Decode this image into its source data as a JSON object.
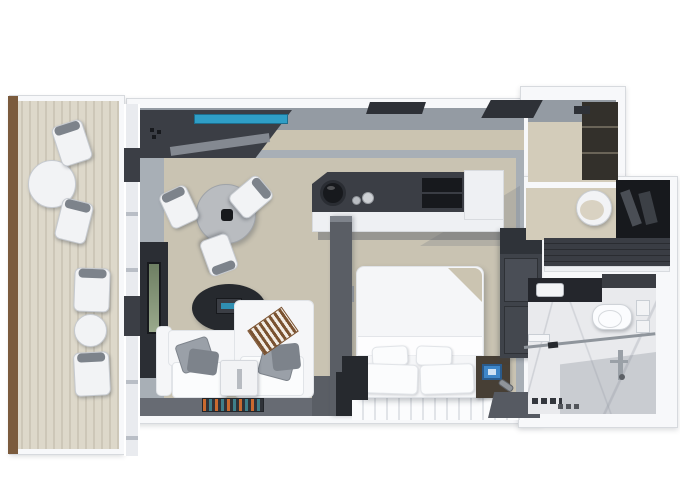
{
  "canvas": {
    "width": 680,
    "height": 486,
    "background": "#ffffff",
    "content_type": "3d-rendered suite floor plan, no text"
  },
  "palette": {
    "bg": "#ffffff",
    "wallWhite": "#f7f8fa",
    "wallEdge": "#d7dade",
    "wallGray": "#949ba3",
    "wallBeige": "#cbc4b1",
    "beigeFloor": "#d3ccba",
    "floorGray": "#a8afb6",
    "carpet": "#c9c3b2",
    "deckA": "#ddd8ca",
    "deckB": "#cdc7b8",
    "wood": "#7b5b3d",
    "dark": "#3b3e45",
    "darker": "#26292e",
    "darkest": "#17191d",
    "slate": "#5a5e65",
    "slate2": "#676b73",
    "sofaWhite": "#f5f6f8",
    "cushion": "#fbfcfd",
    "cushionEdge": "#e1e4e8",
    "pillow": "#9aa0a8",
    "pillowDark": "#7d838b",
    "throwBrown": "#7a5230",
    "throwCream": "#f2ece4",
    "teal": "#2f9ec6",
    "tealDark": "#1d6e8e",
    "safeBlue": "#3e86c8",
    "marble": "#e9eaed",
    "showerShade": "rgba(130,136,145,0.30)",
    "woodNight": "#473f35",
    "tvGreen1": "#6e7f63",
    "tvGreen2": "#9aa98c",
    "chairWhite": "#f2f3f5",
    "chairEdge": "#c6cad0",
    "tableGray": "#b9bcc0",
    "closetBrown": "#33302b",
    "rugBase": "#2f3238",
    "rugOrange": "#c96a2f",
    "rugTeal": "#3f7f8a",
    "threshold": "#565a62",
    "wardrobe": "#3f434a",
    "wardrobeDoor": "#4a4e56",
    "counter": "#3a3d44",
    "basinBeige": "#d9d2c2"
  },
  "rooms": [
    {
      "id": "balcony",
      "label": "Balcony",
      "furniture": [
        "round dining table",
        "2 dining chairs",
        "2 lounge chairs",
        "round side table",
        "wood deck planks",
        "wood privacy divider"
      ]
    },
    {
      "id": "living-room",
      "label": "Living Room",
      "furniture": [
        "media console with teal screen strip",
        "wall tv unit",
        "round dining table with 3 white chairs",
        "dark oval side table with radio-clock",
        "white sofa with 2 gray pillows and striped brown throw",
        "white coffee table",
        "multicolor doormat rug"
      ]
    },
    {
      "id": "bedroom",
      "label": "Bedroom",
      "furniture": [
        "double bed with folded beige corner and 4 white pillows",
        "dark left nightstand",
        "wood right nightstand with blue-screen tablet",
        "flashlight",
        "minibar console with ice bucket, bottles and cabinet",
        "partition wall",
        "white plank floor strip",
        "wardrobe column"
      ]
    },
    {
      "id": "entry-hall",
      "label": "Entry Hall",
      "furniture": [
        "dark entry closet",
        "ceiling vents on top wall"
      ]
    },
    {
      "id": "dressing-area",
      "label": "Dressing Area",
      "furniture": [
        "round vanity basin",
        "dark closet with hanging clothes",
        "dark wood counter"
      ]
    },
    {
      "id": "bathroom",
      "label": "Bathroom",
      "furniture": [
        "dark vanity counter with white sink",
        "wall-hung toilet",
        "2 towel racks",
        "wall towel",
        "glass shower partition with handle",
        "shower fixture with cross handle",
        "floor drains",
        "marble floor"
      ]
    }
  ]
}
